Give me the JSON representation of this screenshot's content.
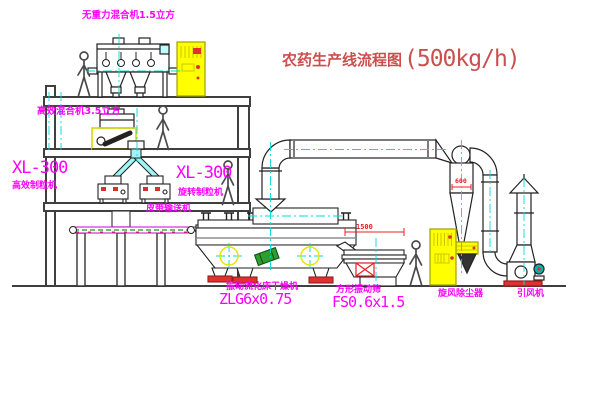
{
  "title": {
    "cn": "农药生产线流程图",
    "capacity": "(500kg/h)"
  },
  "labels": {
    "top_mixer": "无重力混合机1.5立方",
    "second_mixer": "高效混合机3.5立方",
    "granulator_left_model": "XL-300",
    "granulator_left_name": "高效制粒机",
    "granulator_mid_model": "XL-300",
    "granulator_mid_name": "旋转制粒机",
    "belt_conveyor": "皮带输送机",
    "dryer_name": "振动流化床干燥机",
    "dryer_model": "ZLG6x0.75",
    "sieve_name": "方形振动筛",
    "sieve_model": "FS0.6x1.5",
    "cyclone_name": "旋风除尘器",
    "fan_name": "引风机"
  },
  "dimensions": {
    "sieve_length_mm": "1500",
    "cyclone_body_mm": "600"
  },
  "colors": {
    "label_magenta": "#ff00ff",
    "title_red": "#cc4f4f",
    "dimension_red": "#e82020",
    "centerline_cyan": "#00dcdc",
    "cabinet_yellow": "#ffff00",
    "motor_green": "#2ca02c",
    "motor_teal": "#00b3b3",
    "base_red": "#e03030",
    "structure_gray": "#3f3f3f"
  }
}
